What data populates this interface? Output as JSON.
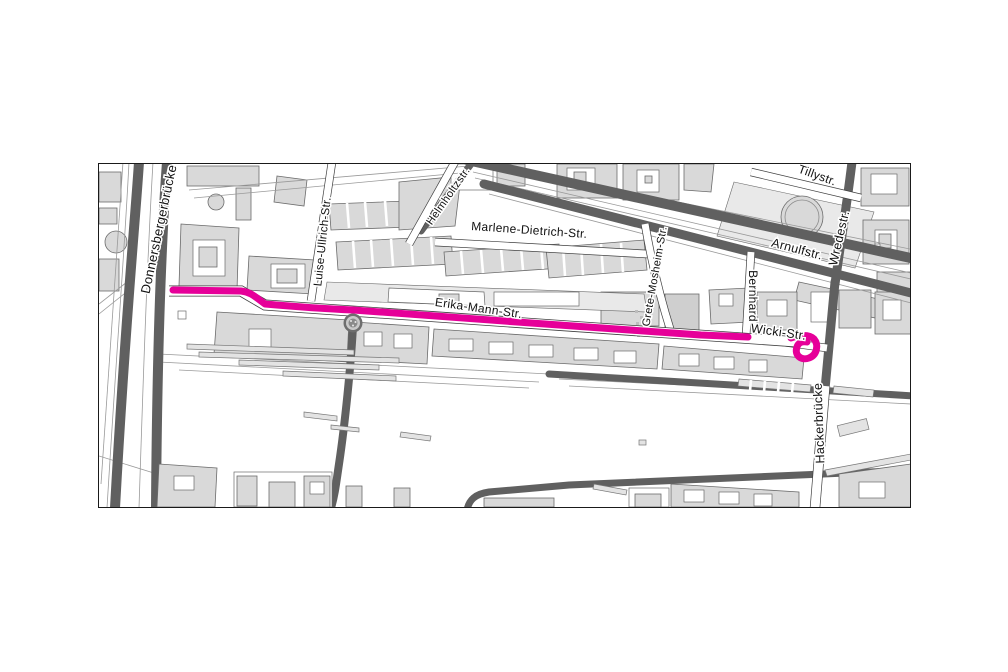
{
  "map": {
    "kind": "street-map-figure",
    "street_labels": [
      {
        "id": "donnersbergerbruecke",
        "name": "Donnersbergerbrücke"
      },
      {
        "id": "luise-ullrich-str",
        "name": "Luise-Ullrich-Str."
      },
      {
        "id": "helmholtzstr",
        "name": "Helmholtzstr."
      },
      {
        "id": "marlene-dietrich-str",
        "name": "Marlene-Dietrich-Str."
      },
      {
        "id": "erika-mann-str",
        "name": "Erika-Mann-Str."
      },
      {
        "id": "grete-mosheim-str",
        "name": "Grete-Mosheim-Str."
      },
      {
        "id": "tillystr",
        "name": "Tillystr."
      },
      {
        "id": "arnulfstr",
        "name": "Arnulfstr."
      },
      {
        "id": "wredestr",
        "name": "Wredestr."
      },
      {
        "id": "bernhard",
        "name": "Bernhard"
      },
      {
        "id": "wicki-str",
        "name": "Wicki-Str."
      },
      {
        "id": "hackerbruecke",
        "name": "Hackerbrücke"
      }
    ],
    "highlighted_route": {
      "color": "#e60099"
    }
  },
  "colors": {
    "page_bg": "#ffffff",
    "map_bg": "#ffffff",
    "frame_border": "#1a1a1a",
    "building_fill": "#d9d9d9",
    "building_stroke": "#6b6b6b",
    "plaza_fill": "#e9e9e9",
    "road_dark": "#606060",
    "rail_line": "#9a9a9a",
    "casing": "#3f3f3f",
    "route_color": "#e60099",
    "label_color": "#111111",
    "label_halo": "#ffffff"
  }
}
